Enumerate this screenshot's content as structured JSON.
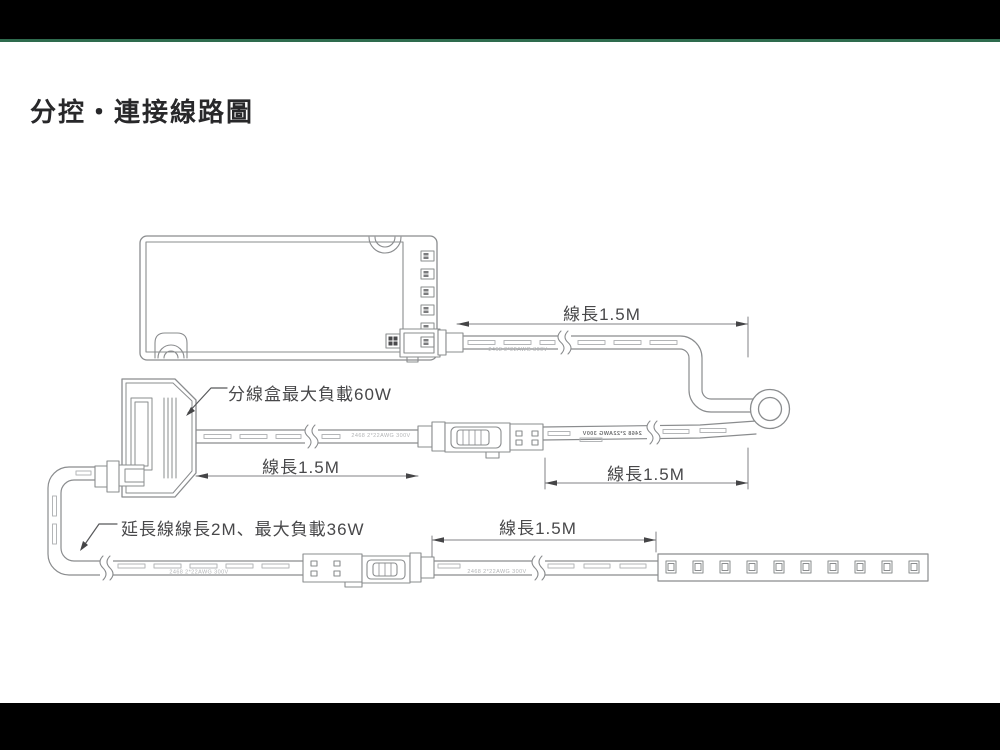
{
  "page": {
    "background_color": "#ffffff",
    "top_bar_color": "#000000",
    "bottom_bar_color": "#000000",
    "accent_line_color": "#2E6B4E"
  },
  "header": {
    "title": "分控・連接線路圖"
  },
  "diagram": {
    "callouts": {
      "splitter_box": "分線盒最大負載60W",
      "extension_wire": "延長線線長2M、最大負載36W"
    },
    "dimensions": {
      "controller_wire": "線長1.5M",
      "splitter_left_wire": "線長1.5M",
      "splitter_right_wire": "線長1.5M",
      "strip_wire": "線長1.5M"
    },
    "wire_marking": "2468 2*22AWG 300V",
    "colors": {
      "outline": "#8a8c8e",
      "dash": "#b3b5b7",
      "dimension": "#808285",
      "label_text": "#48484a",
      "marking_text": "#b2b4b6"
    }
  }
}
